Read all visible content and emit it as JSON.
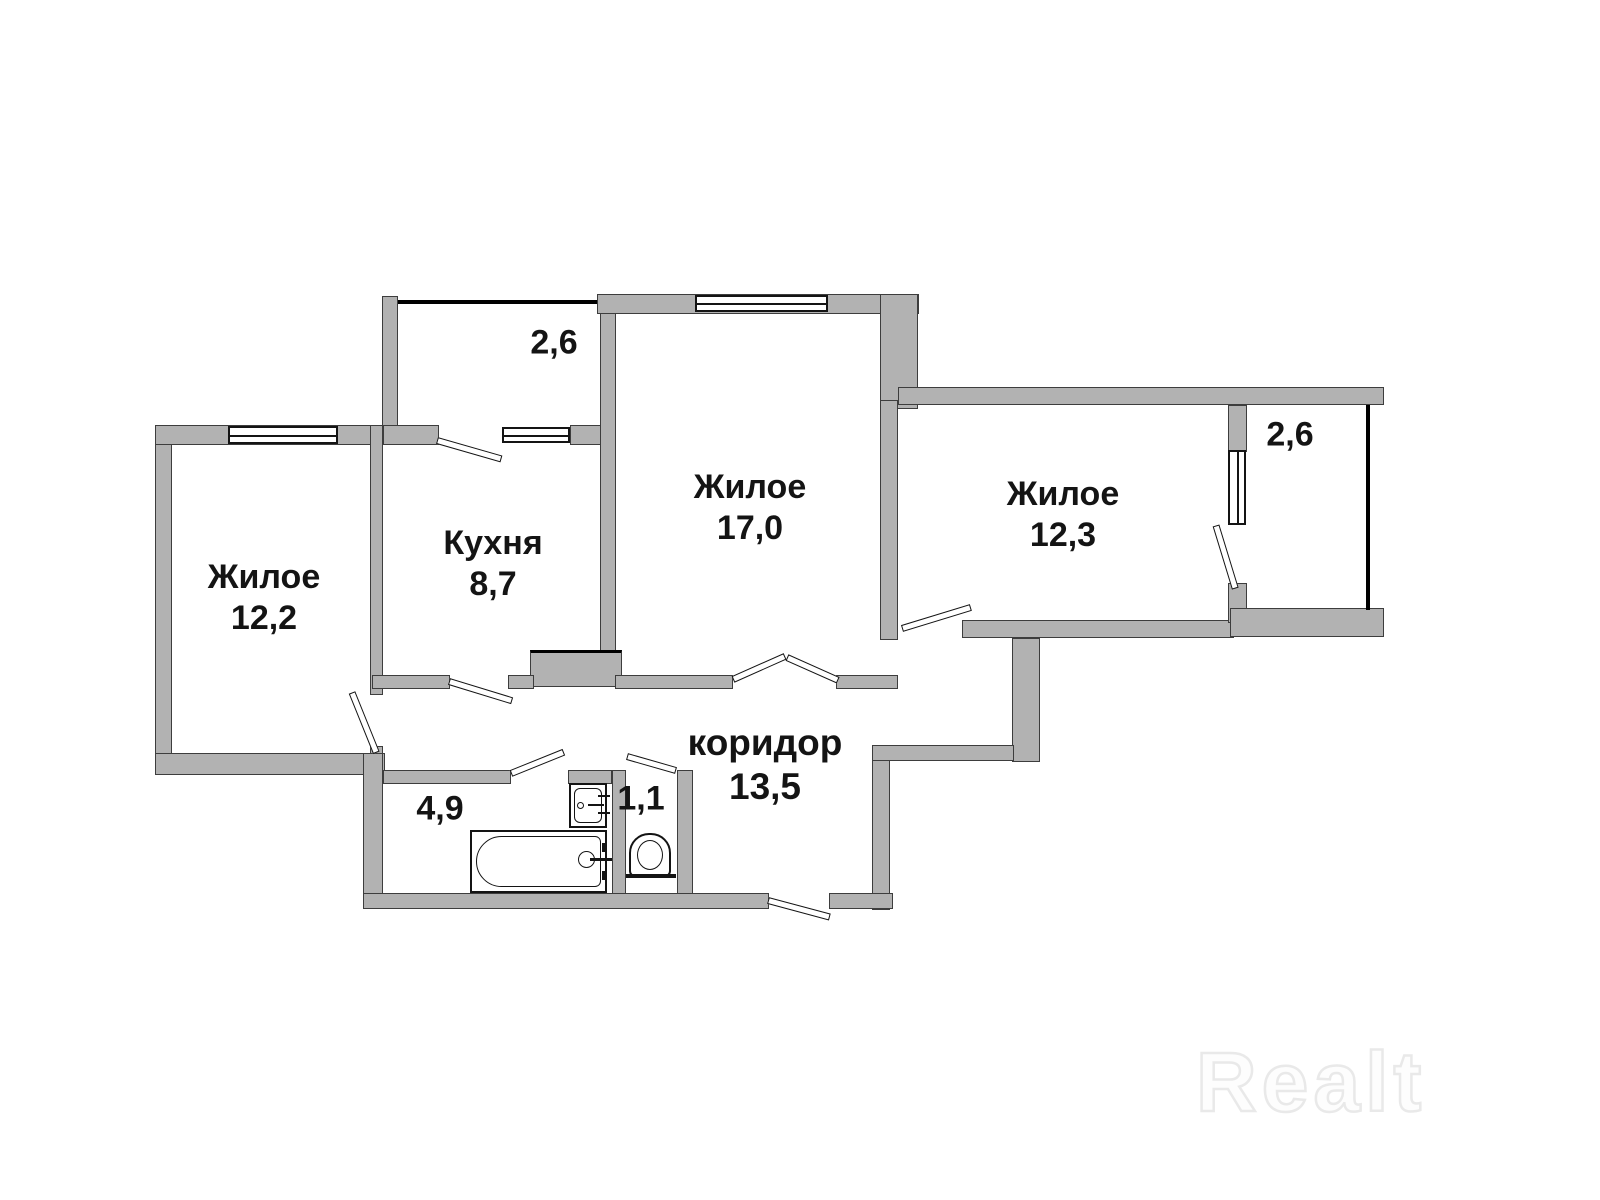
{
  "plan": {
    "rooms": [
      {
        "name": "Жилое",
        "area": "12,2"
      },
      {
        "name": "Кухня",
        "area": "8,7"
      },
      {
        "name": "Жилое",
        "area": "17,0"
      },
      {
        "name": "Жилое",
        "area": "12,3"
      },
      {
        "name": "коридор",
        "area": "13,5"
      }
    ],
    "balconies": [
      {
        "area": "2,6"
      },
      {
        "area": "2,6"
      }
    ],
    "bathroom": {
      "area": "4,9"
    },
    "toilet": {
      "area": "1,1"
    },
    "fixtures": [
      "bathtub-icon",
      "sink-icon",
      "toilet-icon"
    ]
  },
  "watermark": {
    "text": "Realt"
  },
  "colors": {
    "wall": "#b2b2b2",
    "outline": "#3d3d3d",
    "text": "#141414",
    "watermark": "#e9e9e9",
    "background": "#ffffff"
  }
}
